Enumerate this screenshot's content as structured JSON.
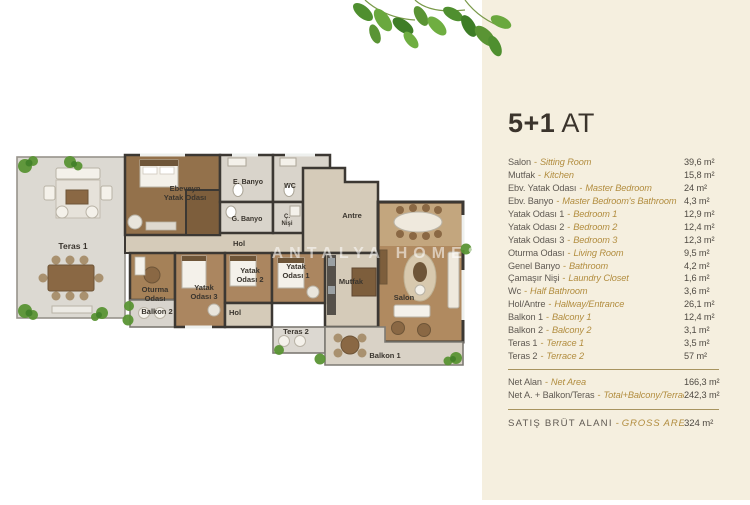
{
  "panel": {
    "title_bold": "5+1",
    "title_light": "AT",
    "sep": "-",
    "rows": [
      {
        "tr": "Salon",
        "en": "Sitting Room",
        "value": "39,6 m²"
      },
      {
        "tr": "Mutfak",
        "en": "Kitchen",
        "value": "15,8 m²"
      },
      {
        "tr": "Ebv. Yatak Odası",
        "en": "Master Bedroom",
        "value": "24 m²"
      },
      {
        "tr": "Ebv. Banyo",
        "en": "Master Bedroom's Bathroom",
        "value": "4,3 m²"
      },
      {
        "tr": "Yatak Odası 1",
        "en": "Bedroom 1",
        "value": "12,9 m²"
      },
      {
        "tr": "Yatak Odası 2",
        "en": "Bedroom 2",
        "value": "12,4 m²"
      },
      {
        "tr": "Yatak Odası 3",
        "en": "Bedroom 3",
        "value": "12,3 m²"
      },
      {
        "tr": "Oturma Odası",
        "en": "Living Room",
        "value": "9,5 m²"
      },
      {
        "tr": "Genel Banyo",
        "en": "Bathroom",
        "value": "4,2 m²"
      },
      {
        "tr": "Çamaşır Nişi",
        "en": "Laundry Closet",
        "value": "1,6 m²"
      },
      {
        "tr": "Wc",
        "en": "Half Bathroom",
        "value": "3,6 m²"
      },
      {
        "tr": "Hol/Antre",
        "en": "Hallway/Entrance",
        "value": "26,1 m²"
      },
      {
        "tr": "Balkon 1",
        "en": "Balcony 1",
        "value": "12,4 m²"
      },
      {
        "tr": "Balkon 2",
        "en": "Balcony 2",
        "value": "3,1 m²"
      },
      {
        "tr": "Teras 1",
        "en": "Terrace 1",
        "value": "3,5 m²"
      },
      {
        "tr": "Teras 2",
        "en": "Terrace 2",
        "value": "57 m²"
      }
    ],
    "totals": [
      {
        "tr": "Net Alan",
        "en": "Net Area",
        "value": "166,3 m²"
      },
      {
        "tr": "Net A. + Balkon/Teras",
        "en": "Total+Balcony/Terrace",
        "value": "242,3 m²"
      }
    ],
    "gross": {
      "tr": "SATIŞ BRÜT ALANI",
      "en": "GROSS AREA",
      "value": "324 m²"
    }
  },
  "plan": {
    "watermark": "ANTALYA HOMES",
    "labels": {
      "teras1": "Teras 1",
      "master_l1": "Ebeveyn",
      "master_l2": "Yatak Odası",
      "e_banyo": "E. Banyo",
      "wc": "WC",
      "g_banyo": "G. Banyo",
      "c_nisi_l1": "Ç.",
      "c_nisi_l2": "Nişi",
      "antre": "Antre",
      "hol": "Hol",
      "oturma_l1": "Oturma",
      "oturma_l2": "Odası",
      "balkon2": "Balkon 2",
      "yatak3_l1": "Yatak",
      "yatak3_l2": "Odası 3",
      "yatak2_l1": "Yatak",
      "yatak2_l2": "Odası 2",
      "hol2": "Hol",
      "yatak1_l1": "Yatak",
      "yatak1_l2": "Odası 1",
      "mutfak": "Mutfak",
      "salon": "Salon",
      "teras2": "Teras 2",
      "balkon1": "Balkon 1"
    }
  },
  "colors": {
    "panel_bg": "#f5efdf",
    "accent_gold": "#b28d3f",
    "text_dark": "#3b342c",
    "text_gray": "#5f5952",
    "divider": "#a8945f",
    "wall": "#3c3833",
    "leaf_green": "#5a9434"
  }
}
